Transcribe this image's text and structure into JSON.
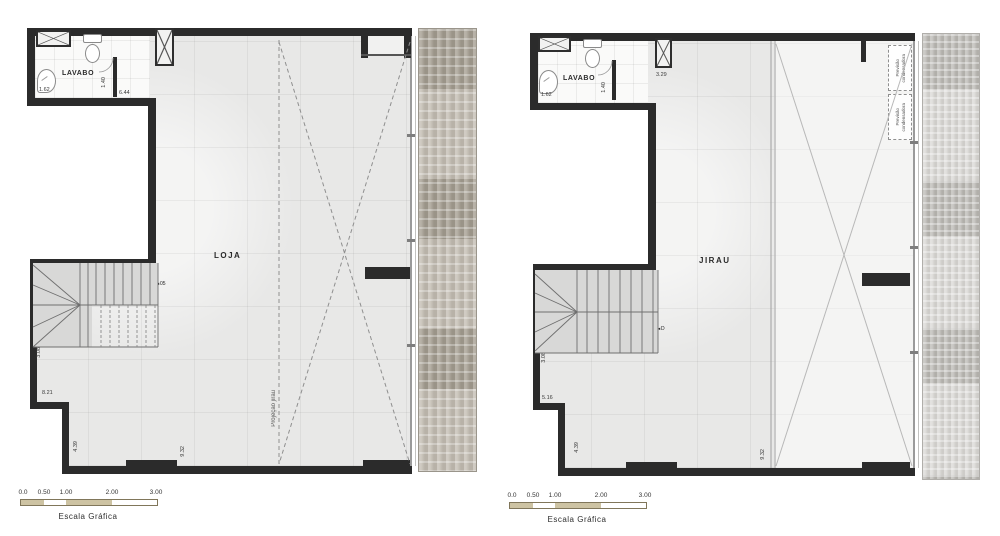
{
  "colors": {
    "wall": "#2b2b2b",
    "floor": "#e8e8e7",
    "lavabo_floor": "#fafaf9",
    "void_area": "#f4f4f3",
    "paver_left": "#b2aa9c",
    "paver_right": "#c8c6c1",
    "scalebar_fill": "#cdc3a3"
  },
  "plans": [
    {
      "name": "loja",
      "room_label": "LOJA",
      "bath_label": "LAVABO",
      "projection_label": "Projeção jirau",
      "stair_marker": {
        "arrow": "◄",
        "label": "05"
      },
      "dims": {
        "sink": "1.62",
        "door": "1.40",
        "hall": "6.44",
        "stair": "3.08",
        "wall_left": "8.21",
        "bottom_left": "4.39",
        "bottom_right": "9.32"
      },
      "scale_bar": {
        "title": "Escala Gráfica",
        "ticks": [
          "0.0",
          "0.50",
          "1.00",
          "2.00",
          "3.00"
        ]
      }
    },
    {
      "name": "jirau",
      "room_label": "JIRAU",
      "bath_label": "LAVABO",
      "condenser": {
        "line1": "Previsão",
        "line2": "condensadora"
      },
      "stair_marker": {
        "arrow": "◄",
        "label": "D"
      },
      "dims": {
        "sink": "1.62",
        "door": "1.40",
        "shaft": "3.29",
        "stair": "3.08",
        "wall_left": "5.16",
        "bottom_left": "4.39",
        "bottom_right": "9.32"
      },
      "scale_bar": {
        "title": "Escala Gráfica",
        "ticks": [
          "0.0",
          "0.50",
          "1.00",
          "2.00",
          "3.00"
        ]
      }
    }
  ]
}
